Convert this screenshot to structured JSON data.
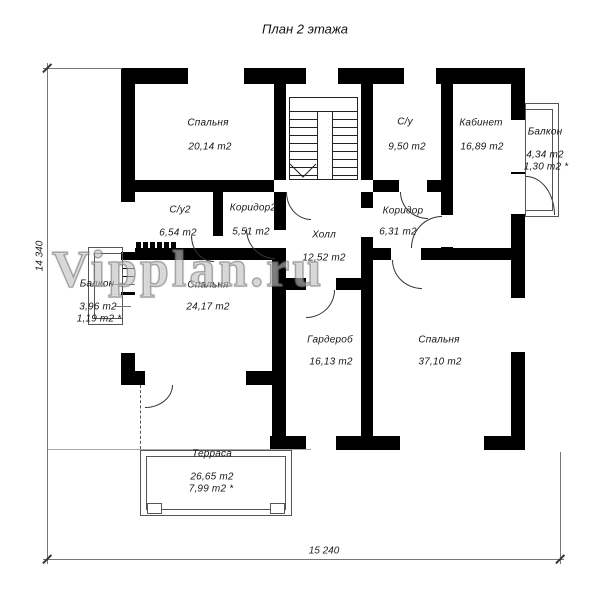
{
  "title": "План 2 этажа",
  "watermark": "Vipplan.ru",
  "rooms": [
    {
      "id": "bedroom-1",
      "name": "Спальня",
      "area": "20,14 m2"
    },
    {
      "id": "bathroom-1",
      "name": "С/у",
      "area": "9,50 m2"
    },
    {
      "id": "office",
      "name": "Кабинет",
      "area": "16,89 m2"
    },
    {
      "id": "balcony-right",
      "name": "Балкон",
      "area": "4,34 m2",
      "area2": "1,30 m2 *"
    },
    {
      "id": "bathroom-2",
      "name": "С/у2",
      "area": "6,54 m2"
    },
    {
      "id": "corridor-2",
      "name": "Коридор2",
      "area": "5,51 m2"
    },
    {
      "id": "hall",
      "name": "Холл",
      "area": "12,52 m2"
    },
    {
      "id": "corridor",
      "name": "Коридор",
      "area": "6,31 m2"
    },
    {
      "id": "balcony-left",
      "name": "Балкон",
      "area": "3,96 m2",
      "area2": "1,19 m2 *"
    },
    {
      "id": "bedroom-2",
      "name": "Спальня",
      "area": "24,17 m2"
    },
    {
      "id": "wardrobe",
      "name": "Гардероб",
      "area": "16,13 m2"
    },
    {
      "id": "bedroom-3",
      "name": "Спальня",
      "area": "37,10 m2"
    },
    {
      "id": "terrace",
      "name": "Терраса",
      "area": "26,65 m2",
      "area2": "7,99 m2 *"
    }
  ],
  "dimensions": {
    "width": "15 240",
    "height": "14 340"
  }
}
